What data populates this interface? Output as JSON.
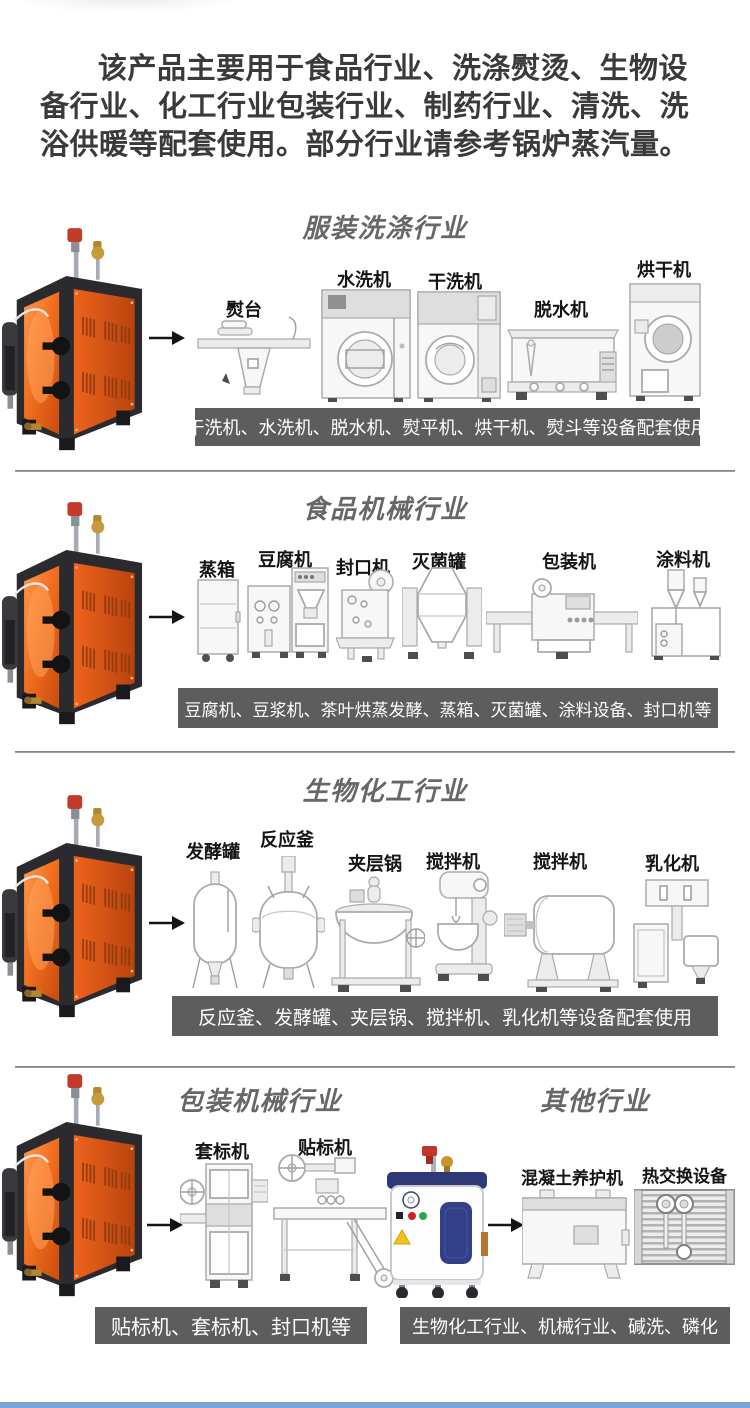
{
  "page": {
    "intro": "该产品主要用于食品行业、洗涤熨烫、生物设备行业、化工行业包装行业、制药行业、清洗、洗浴供暖等配套使用。部分行业请参考锅炉蒸汽量。"
  },
  "colors": {
    "caption_bg": "#5d5d5d",
    "caption_text": "#ffffff",
    "title_gray": "#676767",
    "boiler_orange": "#e8591b",
    "generator_navy": "#2e3a78",
    "bottom_bar_blue": "#7aa7d8"
  },
  "sections": [
    {
      "title": "服装洗涤行业",
      "machines": [
        "熨台",
        "水洗机",
        "干洗机",
        "脱水机",
        "烘干机"
      ],
      "caption": "干洗机、水洗机、脱水机、熨平机、烘干机、熨斗等设备配套使用"
    },
    {
      "title": "食品机械行业",
      "machines": [
        "蒸箱",
        "豆腐机",
        "封口机",
        "灭菌罐",
        "包装机",
        "涂料机"
      ],
      "caption": "豆腐机、豆浆机、茶叶烘蒸发酵、蒸箱、灭菌罐、涂料设备、封口机等"
    },
    {
      "title": "生物化工行业",
      "machines": [
        "发酵罐",
        "反应釜",
        "夹层锅",
        "搅拌机",
        "搅拌机",
        "乳化机"
      ],
      "caption": "反应釜、发酵罐、夹层锅、搅拌机、乳化机等设备配套使用"
    },
    {
      "title": "包装机械行业",
      "machines": [
        "套标机",
        "贴标机"
      ],
      "caption": "贴标机、套标机、封口机等"
    },
    {
      "title": "其他行业",
      "machines": [
        "混凝土养护机",
        "热交换设备"
      ],
      "caption": "生物化工行业、机械行业、碱洗、磷化"
    }
  ]
}
